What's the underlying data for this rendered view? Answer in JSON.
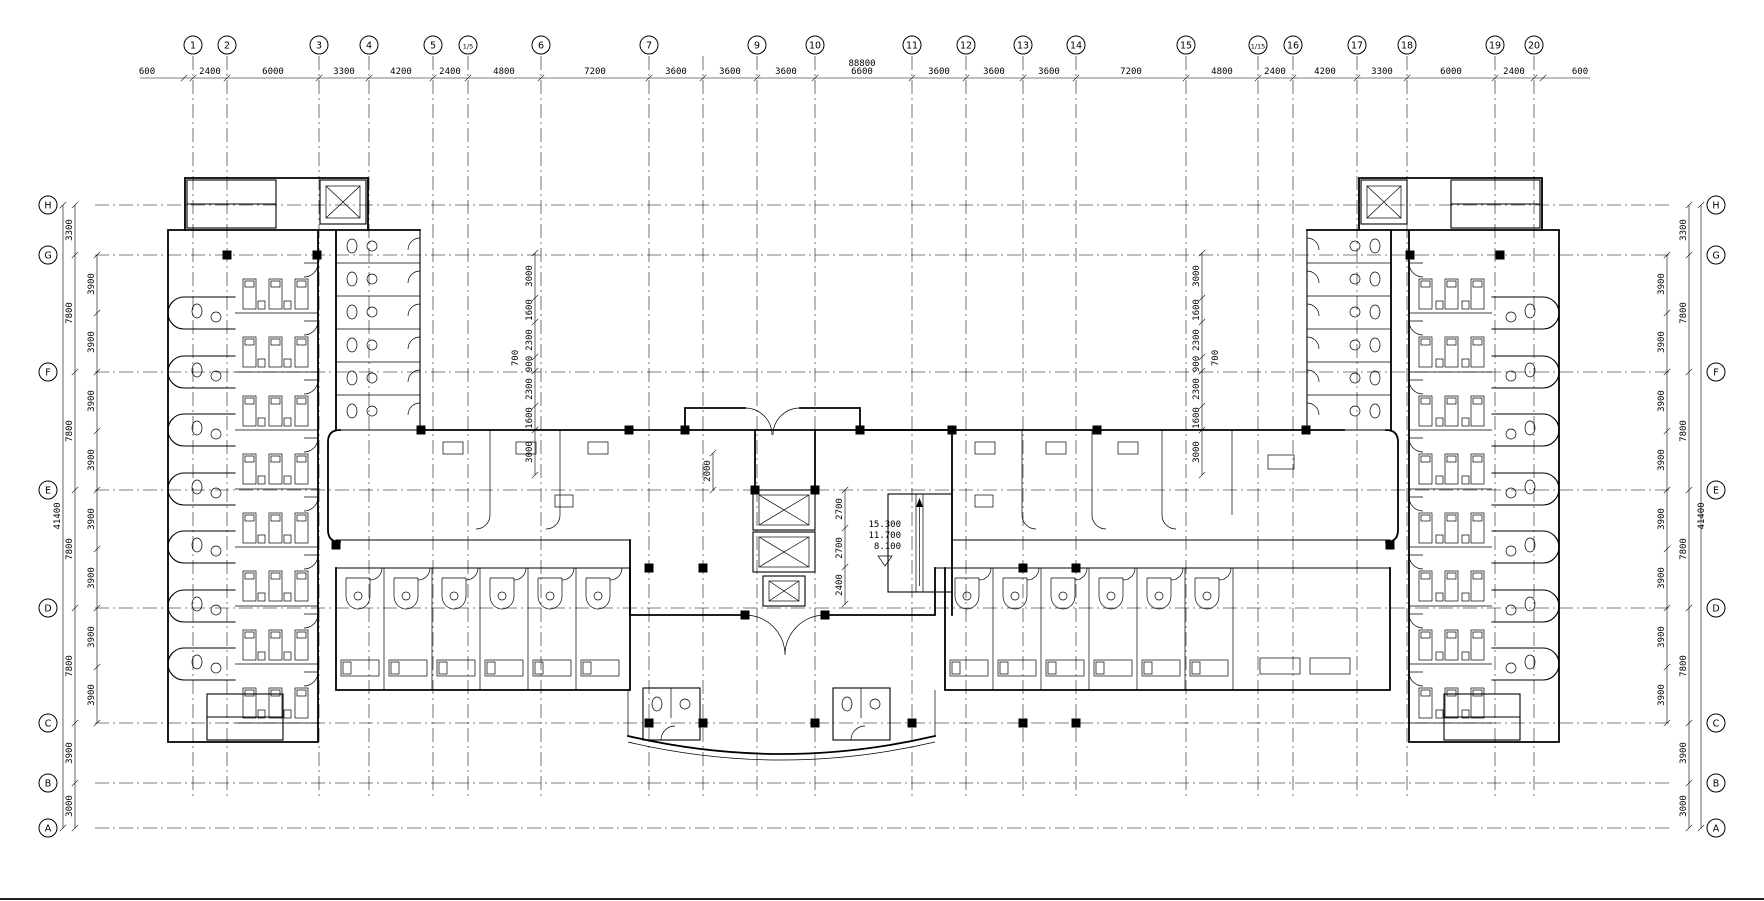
{
  "grid": {
    "top_axes": [
      {
        "label": "1",
        "x": 193
      },
      {
        "label": "2",
        "x": 227
      },
      {
        "label": "3",
        "x": 319
      },
      {
        "label": "4",
        "x": 369
      },
      {
        "label": "5",
        "x": 433
      },
      {
        "label": "1/5",
        "x": 468
      },
      {
        "label": "6",
        "x": 541
      },
      {
        "label": "7",
        "x": 649
      },
      {
        "label": "",
        "x": 703
      },
      {
        "label": "9",
        "x": 757
      },
      {
        "label": "10",
        "x": 815
      },
      {
        "label": "11",
        "x": 912
      },
      {
        "label": "12",
        "x": 966
      },
      {
        "label": "13",
        "x": 1023
      },
      {
        "label": "14",
        "x": 1076
      },
      {
        "label": "15",
        "x": 1186
      },
      {
        "label": "1/15",
        "x": 1258
      },
      {
        "label": "16",
        "x": 1293
      },
      {
        "label": "17",
        "x": 1357
      },
      {
        "label": "18",
        "x": 1407
      },
      {
        "label": "19",
        "x": 1495
      },
      {
        "label": "20",
        "x": 1534
      }
    ],
    "left_rows": [
      {
        "label": "H",
        "y": 205
      },
      {
        "label": "G",
        "y": 255
      },
      {
        "label": "F",
        "y": 372
      },
      {
        "label": "E",
        "y": 490
      },
      {
        "label": "D",
        "y": 608
      },
      {
        "label": "C",
        "y": 723
      },
      {
        "label": "B",
        "y": 783
      },
      {
        "label": "A",
        "y": 828
      }
    ],
    "right_rows": [
      {
        "label": "H",
        "y": 205
      },
      {
        "label": "G",
        "y": 255
      },
      {
        "label": "F",
        "y": 372
      },
      {
        "label": "E",
        "y": 490
      },
      {
        "label": "D",
        "y": 608
      },
      {
        "label": "C",
        "y": 723
      },
      {
        "label": "B",
        "y": 783
      },
      {
        "label": "A",
        "y": 828
      }
    ]
  },
  "dimensions": {
    "top": [
      {
        "text": "600",
        "x": 147
      },
      {
        "text": "2400",
        "x": 210
      },
      {
        "text": "6000",
        "x": 273
      },
      {
        "text": "3300",
        "x": 344
      },
      {
        "text": "4200",
        "x": 401
      },
      {
        "text": "2400",
        "x": 450
      },
      {
        "text": "4800",
        "x": 504
      },
      {
        "text": "7200",
        "x": 595
      },
      {
        "text": "3600",
        "x": 676
      },
      {
        "text": "3600",
        "x": 730
      },
      {
        "text": "3600",
        "x": 786
      },
      {
        "text": "6600",
        "x": 862
      },
      {
        "text": "3600",
        "x": 939
      },
      {
        "text": "3600",
        "x": 994
      },
      {
        "text": "3600",
        "x": 1049
      },
      {
        "text": "7200",
        "x": 1131
      },
      {
        "text": "4800",
        "x": 1222
      },
      {
        "text": "2400",
        "x": 1275
      },
      {
        "text": "4200",
        "x": 1325
      },
      {
        "text": "3300",
        "x": 1382
      },
      {
        "text": "6000",
        "x": 1451
      },
      {
        "text": "2400",
        "x": 1514
      },
      {
        "text": "600",
        "x": 1580
      }
    ],
    "top_total": {
      "text": "88800"
    },
    "left_total": {
      "text": "41400"
    },
    "right_total": {
      "text": "41400"
    },
    "left_outer": [
      {
        "text": "3300",
        "y": 230
      },
      {
        "text": "7800",
        "y": 313
      },
      {
        "text": "7800",
        "y": 431
      },
      {
        "text": "7800",
        "y": 549
      },
      {
        "text": "7800",
        "y": 666
      },
      {
        "text": "3900",
        "y": 753
      },
      {
        "text": "3000",
        "y": 806
      }
    ],
    "left_inner": [
      {
        "text": "3900",
        "y": 284
      },
      {
        "text": "3900",
        "y": 342
      },
      {
        "text": "3900",
        "y": 401
      },
      {
        "text": "3900",
        "y": 460
      },
      {
        "text": "3900",
        "y": 519
      },
      {
        "text": "3900",
        "y": 578
      },
      {
        "text": "3900",
        "y": 637
      },
      {
        "text": "3900",
        "y": 695
      }
    ],
    "right_outer": [
      {
        "text": "3300",
        "y": 230
      },
      {
        "text": "7800",
        "y": 313
      },
      {
        "text": "7800",
        "y": 431
      },
      {
        "text": "7800",
        "y": 549
      },
      {
        "text": "7800",
        "y": 666
      },
      {
        "text": "3900",
        "y": 753
      },
      {
        "text": "3000",
        "y": 806
      }
    ],
    "right_inner": [
      {
        "text": "3900",
        "y": 284
      },
      {
        "text": "3900",
        "y": 342
      },
      {
        "text": "3900",
        "y": 401
      },
      {
        "text": "3900",
        "y": 460
      },
      {
        "text": "3900",
        "y": 519
      },
      {
        "text": "3900",
        "y": 578
      },
      {
        "text": "3900",
        "y": 637
      },
      {
        "text": "3900",
        "y": 695
      }
    ],
    "mid_left_chain": [
      {
        "text": "3000",
        "y": 276
      },
      {
        "text": "1600",
        "y": 310
      },
      {
        "text": "2300",
        "y": 340
      },
      {
        "text": "900",
        "y": 364
      },
      {
        "text": "2300",
        "y": 389
      },
      {
        "text": "1600",
        "y": 418
      },
      {
        "text": "3000",
        "y": 452
      }
    ],
    "mid_left_extra": {
      "text": "700"
    },
    "mid_right_chain": [
      {
        "text": "3000",
        "y": 276
      },
      {
        "text": "1600",
        "y": 310
      },
      {
        "text": "2300",
        "y": 340
      },
      {
        "text": "900",
        "y": 364
      },
      {
        "text": "2300",
        "y": 389
      },
      {
        "text": "1600",
        "y": 418
      },
      {
        "text": "3000",
        "y": 452
      }
    ],
    "mid_right_extra": {
      "text": "700"
    },
    "core": {
      "left_single": {
        "text": "2000"
      },
      "right_chain": [
        {
          "text": "2700",
          "y": 509
        },
        {
          "text": "2700",
          "y": 548
        },
        {
          "text": "2400",
          "y": 585
        }
      ],
      "elevations": [
        "15.300",
        "11.700",
        "8.100"
      ]
    }
  }
}
